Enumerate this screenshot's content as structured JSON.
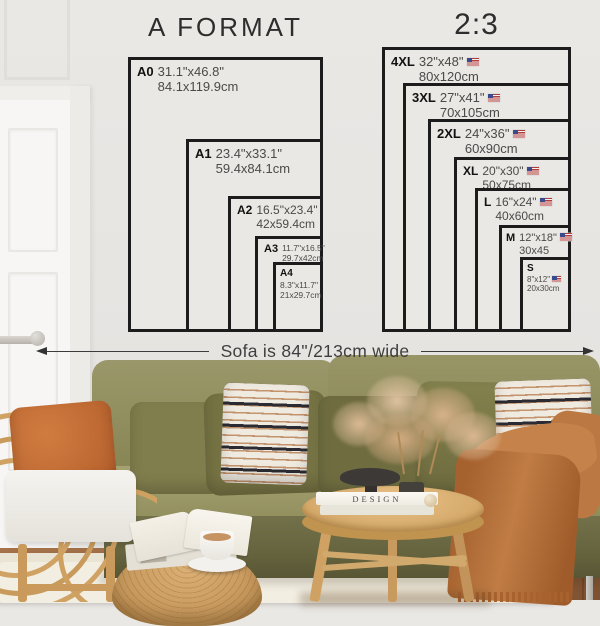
{
  "charts": {
    "a_format": {
      "title": "A FORMAT",
      "sizes": [
        {
          "code": "A0",
          "inches": "31.1\"x46.8\"",
          "cm": "84.1x119.9cm"
        },
        {
          "code": "A1",
          "inches": "23.4\"x33.1\"",
          "cm": "59.4x84.1cm"
        },
        {
          "code": "A2",
          "inches": "16.5\"x23.4\"",
          "cm": "42x59.4cm"
        },
        {
          "code": "A3",
          "inches": "11.7\"x16.5\"",
          "cm": "29.7x42cm"
        },
        {
          "code": "A4",
          "inches": "8.3\"x11.7\"",
          "cm": "21x29.7cm"
        }
      ]
    },
    "ratio_2_3": {
      "title": "2:3",
      "sizes": [
        {
          "code": "4XL",
          "inches": "32\"x48\"",
          "cm": "80x120cm"
        },
        {
          "code": "3XL",
          "inches": "27\"x41\"",
          "cm": "70x105cm"
        },
        {
          "code": "2XL",
          "inches": "24\"x36\"",
          "cm": "60x90cm"
        },
        {
          "code": "XL",
          "inches": "20\"x30\"",
          "cm": "50x75cm"
        },
        {
          "code": "L",
          "inches": "16\"x24\"",
          "cm": "40x60cm"
        },
        {
          "code": "M",
          "inches": "12\"x18\"",
          "cm": "30x45"
        },
        {
          "code": "S",
          "inches": "8\"x12\"",
          "cm": "20x30cm"
        }
      ]
    }
  },
  "sofa_note": "Sofa is 84\"/213cm wide",
  "scene": {
    "book_spine_title": "DESIGN"
  },
  "icons": {
    "flag": "us-flag-icon",
    "arrow": "double-headed-arrow"
  },
  "colors": {
    "wall": "#e8e6e3",
    "chart_line": "#1c1c1c",
    "sofa_olive": "#8f8c5e",
    "pillow_olive": "#73713f",
    "rust_throw": "#b9713c",
    "rattan": "#cda164",
    "rug": "#eae4d4",
    "wood_floor": "#96653f"
  }
}
